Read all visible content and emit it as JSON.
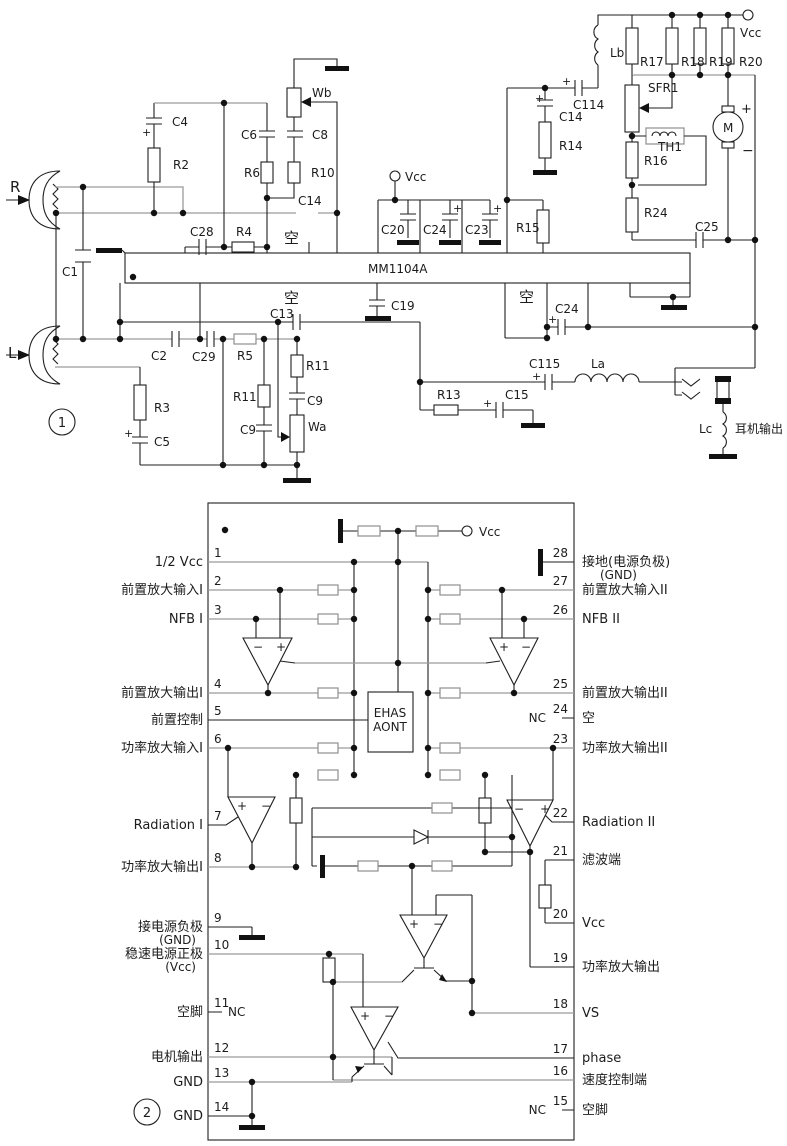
{
  "meta": {
    "ink": "#1f1f1f",
    "gray": "#9a9a9a",
    "background": "#ffffff"
  },
  "figure1": {
    "badge": "1",
    "chip_label": "MM1104A",
    "labels": [
      {
        "t": "R",
        "x": 10,
        "y": 192,
        "s": 15
      },
      {
        "t": "L",
        "x": 8,
        "y": 358,
        "s": 15
      },
      {
        "t": "C1",
        "x": 62,
        "y": 276
      },
      {
        "t": "C4",
        "x": 172,
        "y": 126
      },
      {
        "t": "R2",
        "x": 173,
        "y": 169
      },
      {
        "t": "C6",
        "x": 241,
        "y": 139
      },
      {
        "t": "R6",
        "x": 244,
        "y": 177
      },
      {
        "t": "C8",
        "x": 312,
        "y": 139
      },
      {
        "t": "R10",
        "x": 311,
        "y": 177
      },
      {
        "t": "Wb",
        "x": 312,
        "y": 97
      },
      {
        "t": "C28",
        "x": 190,
        "y": 236
      },
      {
        "t": "R4",
        "x": 236,
        "y": 236
      },
      {
        "t": "C14",
        "x": 298,
        "y": 205
      },
      {
        "t": "空",
        "x": 284,
        "y": 243,
        "s": 15
      },
      {
        "t": "空",
        "x": 284,
        "y": 303,
        "s": 15
      },
      {
        "t": "C2",
        "x": 151,
        "y": 360
      },
      {
        "t": "C29",
        "x": 192,
        "y": 361
      },
      {
        "t": "R5",
        "x": 237,
        "y": 360
      },
      {
        "t": "C13",
        "x": 270,
        "y": 318
      },
      {
        "t": "R11",
        "x": 233,
        "y": 401
      },
      {
        "t": "C9",
        "x": 240,
        "y": 434
      },
      {
        "t": "R11",
        "x": 306,
        "y": 370
      },
      {
        "t": "C9",
        "x": 307,
        "y": 405
      },
      {
        "t": "Wa",
        "x": 308,
        "y": 431
      },
      {
        "t": "R3",
        "x": 154,
        "y": 412
      },
      {
        "t": "C5",
        "x": 154,
        "y": 446
      },
      {
        "t": "C19",
        "x": 391,
        "y": 310
      },
      {
        "t": "C20",
        "x": 381,
        "y": 234
      },
      {
        "t": "C24",
        "x": 423,
        "y": 234
      },
      {
        "t": "C23",
        "x": 465,
        "y": 234
      },
      {
        "t": "Vcc",
        "x": 405,
        "y": 181
      },
      {
        "t": "R15",
        "x": 516,
        "y": 232
      },
      {
        "t": "C14",
        "x": 559,
        "y": 121
      },
      {
        "t": "R14",
        "x": 559,
        "y": 150
      },
      {
        "t": "C114",
        "x": 573,
        "y": 109
      },
      {
        "t": "Lb",
        "x": 610,
        "y": 57
      },
      {
        "t": "R17",
        "x": 640,
        "y": 66
      },
      {
        "t": "R18",
        "x": 681,
        "y": 66
      },
      {
        "t": "R19",
        "x": 709,
        "y": 66
      },
      {
        "t": "R20",
        "x": 739,
        "y": 66
      },
      {
        "t": "Vcc",
        "x": 740,
        "y": 37
      },
      {
        "t": "SFR1",
        "x": 648,
        "y": 92
      },
      {
        "t": "TH1",
        "x": 658,
        "y": 151
      },
      {
        "t": "R16",
        "x": 644,
        "y": 165
      },
      {
        "t": "R24",
        "x": 644,
        "y": 217
      },
      {
        "t": "C25",
        "x": 695,
        "y": 231
      },
      {
        "t": "空",
        "x": 519,
        "y": 302,
        "s": 15
      },
      {
        "t": "C24",
        "x": 555,
        "y": 313
      },
      {
        "t": "C115",
        "x": 529,
        "y": 368
      },
      {
        "t": "La",
        "x": 591,
        "y": 368
      },
      {
        "t": "R13",
        "x": 437,
        "y": 399
      },
      {
        "t": "C15",
        "x": 505,
        "y": 399
      },
      {
        "t": "Lc",
        "x": 699,
        "y": 433
      },
      {
        "t": "耳机输出",
        "x": 735,
        "y": 433
      },
      {
        "t": "M",
        "x": 723,
        "y": 132,
        "s": 12
      },
      {
        "t": "+",
        "x": 741,
        "y": 113,
        "s": 13
      },
      {
        "t": "−",
        "x": 742,
        "y": 155,
        "s": 14
      },
      {
        "t": "+",
        "x": 142,
        "y": 136,
        "s": 11
      },
      {
        "t": "+",
        "x": 124,
        "y": 437,
        "s": 11
      },
      {
        "t": "+",
        "x": 535,
        "y": 102,
        "s": 11
      },
      {
        "t": "+",
        "x": 562,
        "y": 85,
        "s": 11
      },
      {
        "t": "+",
        "x": 453,
        "y": 212,
        "s": 11
      },
      {
        "t": "+",
        "x": 493,
        "y": 212,
        "s": 11
      },
      {
        "t": "+",
        "x": 548,
        "y": 323,
        "s": 11
      },
      {
        "t": "+",
        "x": 532,
        "y": 380,
        "s": 11
      },
      {
        "t": "+",
        "x": 483,
        "y": 407,
        "s": 11
      }
    ]
  },
  "figure2": {
    "badge": "2",
    "control_block": [
      "EHAS",
      "AONT"
    ],
    "vcc_label": "Vcc",
    "left_pins": [
      {
        "n": "1",
        "label": "1/2 Vcc",
        "y": 562
      },
      {
        "n": "2",
        "label": "前置放大输入I",
        "y": 590
      },
      {
        "n": "3",
        "label": "NFB I",
        "y": 619
      },
      {
        "n": "4",
        "label": "前置放大输出I",
        "y": 693
      },
      {
        "n": "5",
        "label": "前置控制",
        "y": 720
      },
      {
        "n": "6",
        "label": "功率放大输入I",
        "y": 748
      },
      {
        "n": "7",
        "label": "Radiation I",
        "y": 825
      },
      {
        "n": "8",
        "label": "功率放大输出I",
        "y": 867
      },
      {
        "n": "9",
        "label": "接电源负极",
        "label2": "(GND)",
        "y": 927
      },
      {
        "n": "10",
        "label": "稳速电源正极",
        "label2": "(Vcc)",
        "y": 954
      },
      {
        "n": "11",
        "label": "空脚",
        "inside": "NC",
        "y": 1012
      },
      {
        "n": "12",
        "label": "电机输出",
        "y": 1057
      },
      {
        "n": "13",
        "label": "GND",
        "y": 1082
      },
      {
        "n": "14",
        "label": "GND",
        "y": 1116
      }
    ],
    "right_pins": [
      {
        "n": "28",
        "label": "接地(电源负极)",
        "label2": "(GND)",
        "y": 562
      },
      {
        "n": "27",
        "label": "前置放大输入II",
        "y": 590
      },
      {
        "n": "26",
        "label": "NFB II",
        "y": 619
      },
      {
        "n": "25",
        "label": "前置放大输出II",
        "y": 693
      },
      {
        "n": "24",
        "label": "空",
        "inside": "NC",
        "y": 718
      },
      {
        "n": "23",
        "label": "功率放大输出II",
        "y": 748
      },
      {
        "n": "22",
        "label": "Radiation II",
        "y": 822
      },
      {
        "n": "21",
        "label": "滤波端",
        "y": 860
      },
      {
        "n": "20",
        "label": "Vcc",
        "y": 923
      },
      {
        "n": "19",
        "label": "功率放大输出",
        "y": 967
      },
      {
        "n": "18",
        "label": "VS",
        "y": 1013
      },
      {
        "n": "17",
        "label": "phase",
        "y": 1058
      },
      {
        "n": "16",
        "label": "速度控制端",
        "y": 1080
      },
      {
        "n": "15",
        "label": "空脚",
        "inside": "NC",
        "y": 1110
      }
    ],
    "inner_labels": [
      {
        "t": "EHAS",
        "x": 390,
        "y": 717,
        "s": 12,
        "a": "middle"
      },
      {
        "t": "AONT",
        "x": 390,
        "y": 731,
        "s": 12,
        "a": "middle"
      },
      {
        "t": "Vcc",
        "x": 479,
        "y": 536
      },
      {
        "t": "−",
        "x": 253,
        "y": 651
      },
      {
        "t": "+",
        "x": 276,
        "y": 651
      },
      {
        "t": "+",
        "x": 499,
        "y": 651
      },
      {
        "t": "−",
        "x": 521,
        "y": 651
      },
      {
        "t": "+",
        "x": 237,
        "y": 810
      },
      {
        "t": "−",
        "x": 261,
        "y": 810
      },
      {
        "t": "−",
        "x": 514,
        "y": 813
      },
      {
        "t": "+",
        "x": 540,
        "y": 813
      },
      {
        "t": "+",
        "x": 409,
        "y": 928
      },
      {
        "t": "−",
        "x": 433,
        "y": 928
      },
      {
        "t": "+",
        "x": 360,
        "y": 1020
      },
      {
        "t": "−",
        "x": 384,
        "y": 1020
      }
    ]
  }
}
